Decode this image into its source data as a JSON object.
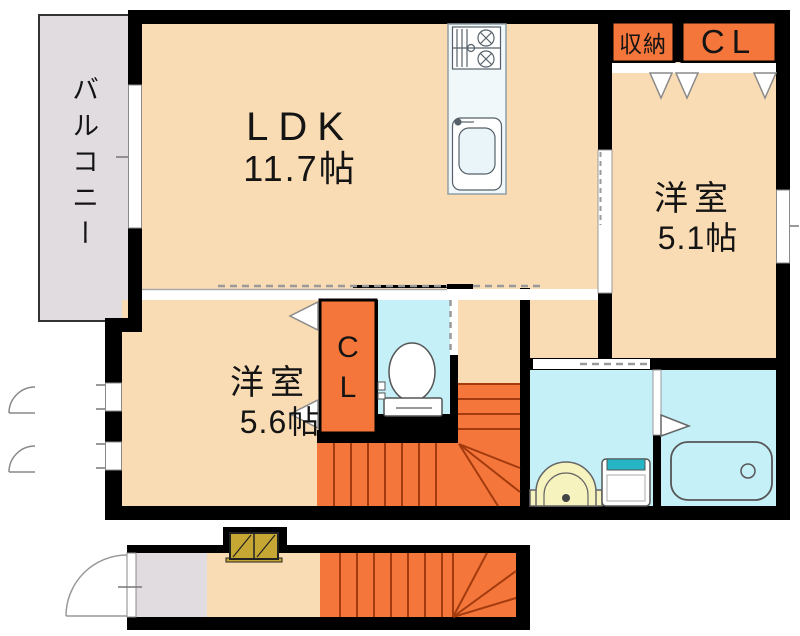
{
  "colors": {
    "room_fill": "#FADCB4",
    "balcony_fill": "#E0DCDF",
    "accent_orange": "#F4763A",
    "wet_area_cyan": "#C5F0F8",
    "stair_tread_line": "#A33B0F",
    "wall_black": "#000000",
    "washbasin_yellow": "#F7F3BE",
    "washer_teal": "#25B5C5",
    "shoebox_olive": "#C7A733"
  },
  "second_floor": {
    "balcony": {
      "label": "バルコニー"
    },
    "ldk": {
      "label": "LDK",
      "size": "11.7帖"
    },
    "storage": {
      "label": "収納"
    },
    "closet": {
      "label": "CL"
    },
    "western_room_5_1": {
      "label": "洋室",
      "size": "5.1帖"
    },
    "hall_closet": {
      "char1": "C",
      "char2": "L"
    },
    "western_room_5_6": {
      "label": "洋室",
      "size": "5.6帖"
    }
  }
}
